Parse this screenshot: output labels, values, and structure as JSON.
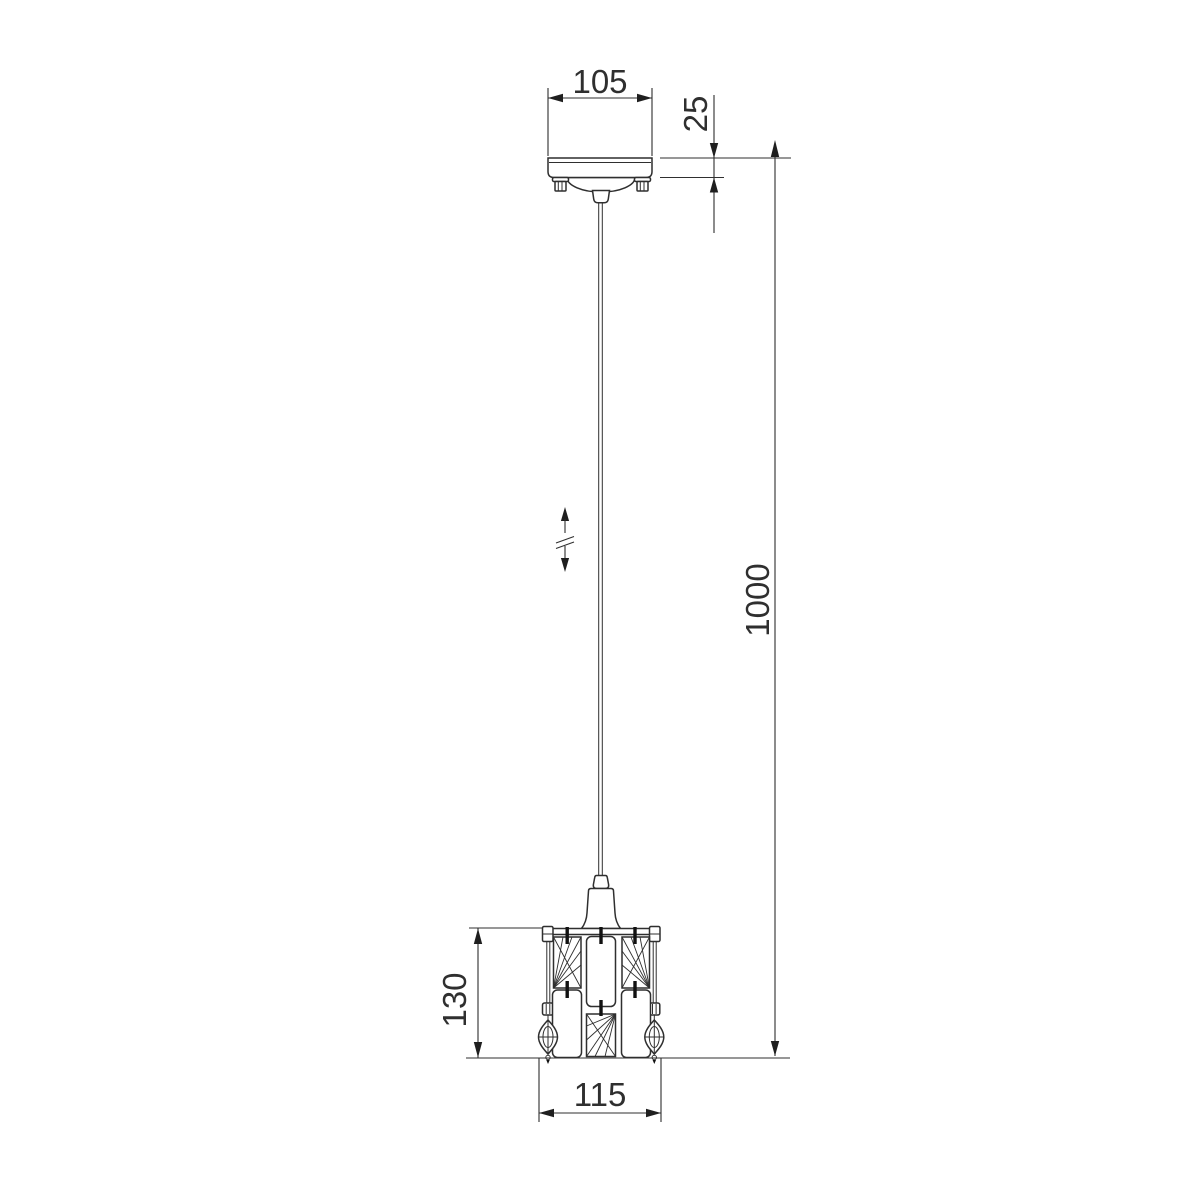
{
  "canvas": {
    "background": "#ffffff",
    "ink": "#2f2f2f"
  },
  "labels": {
    "canopy_width": "105",
    "canopy_height": "25",
    "suspension_length": "1000",
    "shade_height": "130",
    "shade_width": "115"
  }
}
